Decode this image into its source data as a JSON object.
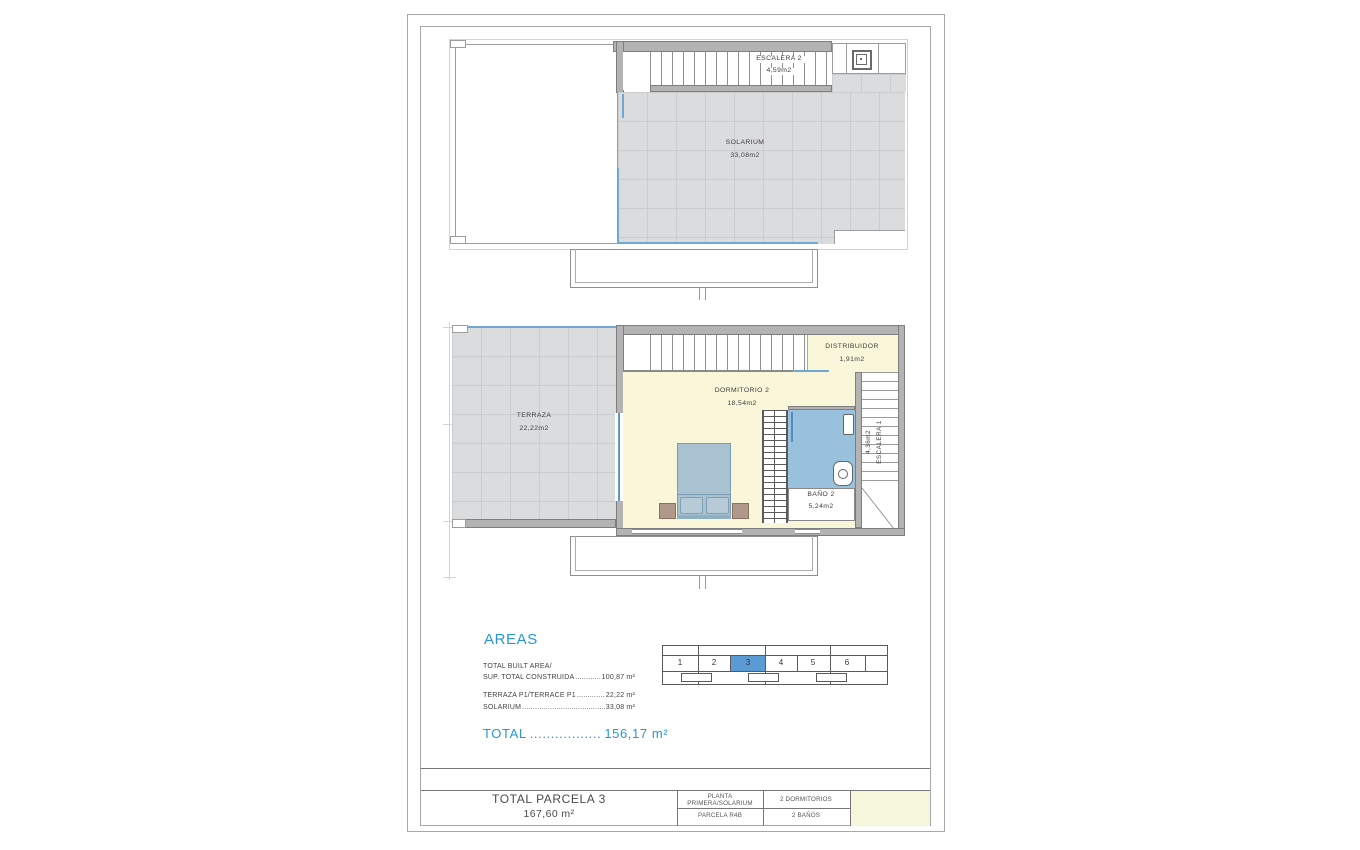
{
  "floor_top": {
    "escalera2": {
      "name": "ESCALERA 2",
      "area": "4,59m2"
    },
    "solarium": {
      "name": "SOLARIUM",
      "area": "33,08m2"
    }
  },
  "floor_first": {
    "terraza": {
      "name": "TERRAZA",
      "area": "22,22m2"
    },
    "dormitorio": {
      "name": "DORMITORIO 2",
      "area": "18,54m2"
    },
    "distribuidor": {
      "name": "DISTRIBUIDOR",
      "area": "1,91m2"
    },
    "bano": {
      "name": "BAÑO 2",
      "area": "5,24m2"
    },
    "escalera1": {
      "name": "ESCALERA 1",
      "area": "4,36m2"
    }
  },
  "areas_panel": {
    "title": "AREAS",
    "built_label_1": "TOTAL BUILT AREA/",
    "built_label_2": "SUP. TOTAL CONSTRUIDA",
    "built_dots": "......................................",
    "built_value": "100,87 m²",
    "terraza_label": "TERRAZA P1/TERRACE P1",
    "terraza_dots": "......................................",
    "terraza_value": "22,22 m²",
    "solarium_label": "SOLARIUM",
    "solarium_dots": "..................................................................",
    "solarium_value": "33,08 m²",
    "total_label": "TOTAL",
    "total_dots": ".................",
    "total_value": "156,17 m²"
  },
  "keyplan": {
    "units": [
      "1",
      "2",
      "3",
      "4",
      "5",
      "6"
    ],
    "highlighted_unit": "3",
    "highlight_color": "#5b9bd5"
  },
  "title_block": {
    "parcel_title": "TOTAL PARCELA 3",
    "parcel_area": "167,60 m²",
    "planta_line1": "PLANTA",
    "planta_line2": "PRIMERA/SOLARIUM",
    "parcela_ref": "PARCELA R4B",
    "bedrooms": "2 DORMITORIOS",
    "bathrooms": "2 BAÑOS"
  },
  "colors": {
    "accent_blue_text": "#2997d3",
    "bath_blue": "#99c0dd",
    "room_cream": "#faf6da",
    "tile_gray": "#dbdcde",
    "railing_blue": "#6fa8d0"
  }
}
